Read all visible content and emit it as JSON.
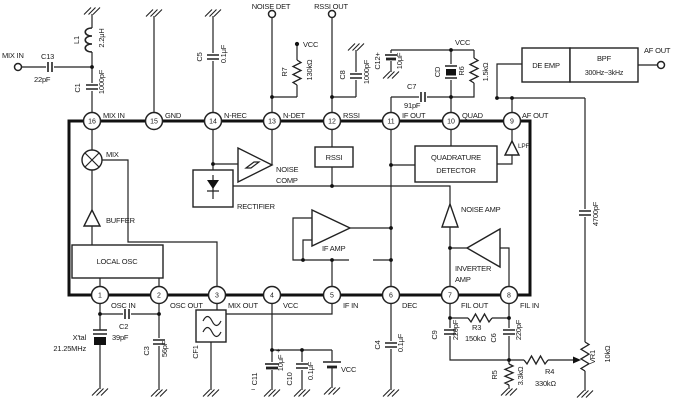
{
  "io": {
    "mix_in": "MIX IN",
    "noise_det": "NOISE DET",
    "rssi_out": "RSSI OUT",
    "af_out": "AF OUT"
  },
  "vcc": {
    "a": "VCC",
    "b": "VCC",
    "c": "VCC"
  },
  "pins": {
    "top": [
      {
        "n": "16",
        "l": "MIX IN"
      },
      {
        "n": "15",
        "l": "GND"
      },
      {
        "n": "14",
        "l": "N-REC"
      },
      {
        "n": "13",
        "l": "N-DET"
      },
      {
        "n": "12",
        "l": "RSSI"
      },
      {
        "n": "11",
        "l": "IF OUT"
      },
      {
        "n": "10",
        "l": "QUAD"
      },
      {
        "n": "9",
        "l": "AF OUT"
      }
    ],
    "bottom": [
      {
        "n": "1",
        "l": "OSC IN"
      },
      {
        "n": "2",
        "l": "OSC OUT"
      },
      {
        "n": "3",
        "l": "MIX OUT"
      },
      {
        "n": "4",
        "l": "VCC"
      },
      {
        "n": "5",
        "l": "IF IN"
      },
      {
        "n": "6",
        "l": "DEC"
      },
      {
        "n": "7",
        "l": "FIL OUT"
      },
      {
        "n": "8",
        "l": "FIL IN"
      }
    ]
  },
  "blocks": {
    "mix": "MIX",
    "buffer": "BUFFER",
    "local_osc": "LOCAL OSC",
    "rectifier": "RECTIFIER",
    "noise_comp1": "NOISE",
    "noise_comp2": "COMP",
    "rssi": "RSSI",
    "if_amp": "IF AMP",
    "quad1": "QUADRATURE",
    "quad2": "DETECTOR",
    "noise_amp": "NOISE AMP",
    "inv1": "INVERTER",
    "inv2": "AMP",
    "lpf": "LPF",
    "de_emp": "DE EMP",
    "bpf": "BPF",
    "bpf_range": "300Hz~3kHz"
  },
  "parts": {
    "c13": {
      "r": "C13",
      "v": "22pF"
    },
    "l1": {
      "r": "L1",
      "v": "2.2μH"
    },
    "c1": {
      "r": "C1",
      "v": "1000pF"
    },
    "c5": {
      "r": "C5",
      "v": "0.1μF"
    },
    "r7": {
      "r": "R7",
      "v": "130kΩ"
    },
    "c8": {
      "r": "C8",
      "v": "1000pF"
    },
    "c12": {
      "r": "C12+",
      "v": "10μF"
    },
    "c7": {
      "r": "C7",
      "v": "91pF"
    },
    "cd": {
      "r": "CD"
    },
    "r6": {
      "r": "R6",
      "v": "1.5kΩ"
    },
    "xtal": {
      "r": "X'tal",
      "v": "21.25MHz"
    },
    "c2": {
      "r": "C2",
      "v": "39pF"
    },
    "c3": {
      "r": "C3",
      "v": "56pF"
    },
    "cf1": {
      "r": "CF1"
    },
    "c11": {
      "r": "C11",
      "v": "10μF",
      "plus": "+",
      "minus": "−"
    },
    "c10": {
      "r": "C10",
      "v": "0.1μF"
    },
    "c4": {
      "r": "C4",
      "v": "0.1μF"
    },
    "c9": {
      "r": "C9",
      "v": "220pF"
    },
    "r3": {
      "r": "R3",
      "v": "150kΩ"
    },
    "c6": {
      "r": "C6",
      "v": "220pF"
    },
    "r5": {
      "r": "R5",
      "v": "3.3kΩ"
    },
    "r4": {
      "r": "R4",
      "v": "330kΩ"
    },
    "vr1": {
      "r": "VR1",
      "v": "10kΩ"
    },
    "caf": {
      "v": "4700pF"
    }
  }
}
